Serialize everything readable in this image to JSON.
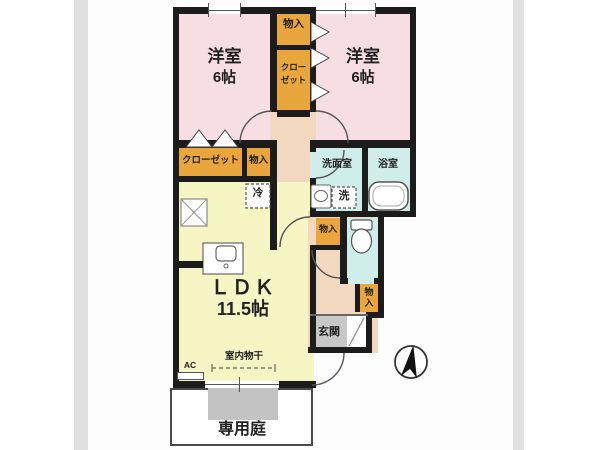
{
  "labels": {
    "bedroom1_name": "洋室",
    "bedroom1_size": "6帖",
    "bedroom2_name": "洋室",
    "bedroom2_size": "6帖",
    "storage_top": "物入",
    "closet_top_line1": "クロー",
    "closet_top_line2": "ゼット",
    "closet_mid": "クローゼット",
    "storage_mid": "物入",
    "washroom": "洗面室",
    "bathroom": "浴室",
    "washer": "洗",
    "fridge": "冷",
    "storage_toilet": "物入",
    "storage_hall_line1": "物",
    "storage_hall_line2": "入",
    "ldk_name": "ＬＤＫ",
    "ldk_size": "11.5帖",
    "entrance": "玄関",
    "indoor_laundry": "室内物干",
    "ac": "AC",
    "private_garden": "専用庭"
  },
  "colors": {
    "bedroom": "#f7dee2",
    "ldk": "#f6f6c5",
    "storage": "#e9a63c",
    "wet": "#cfeeea",
    "hall": "#f2d8bf",
    "entry_tile": "#c7c7c7",
    "terrace": "#c3c3c3",
    "wall": "#1c1c1c",
    "photo_bg": "#fdfdfd",
    "photo_edge": "#e1e1e1"
  }
}
